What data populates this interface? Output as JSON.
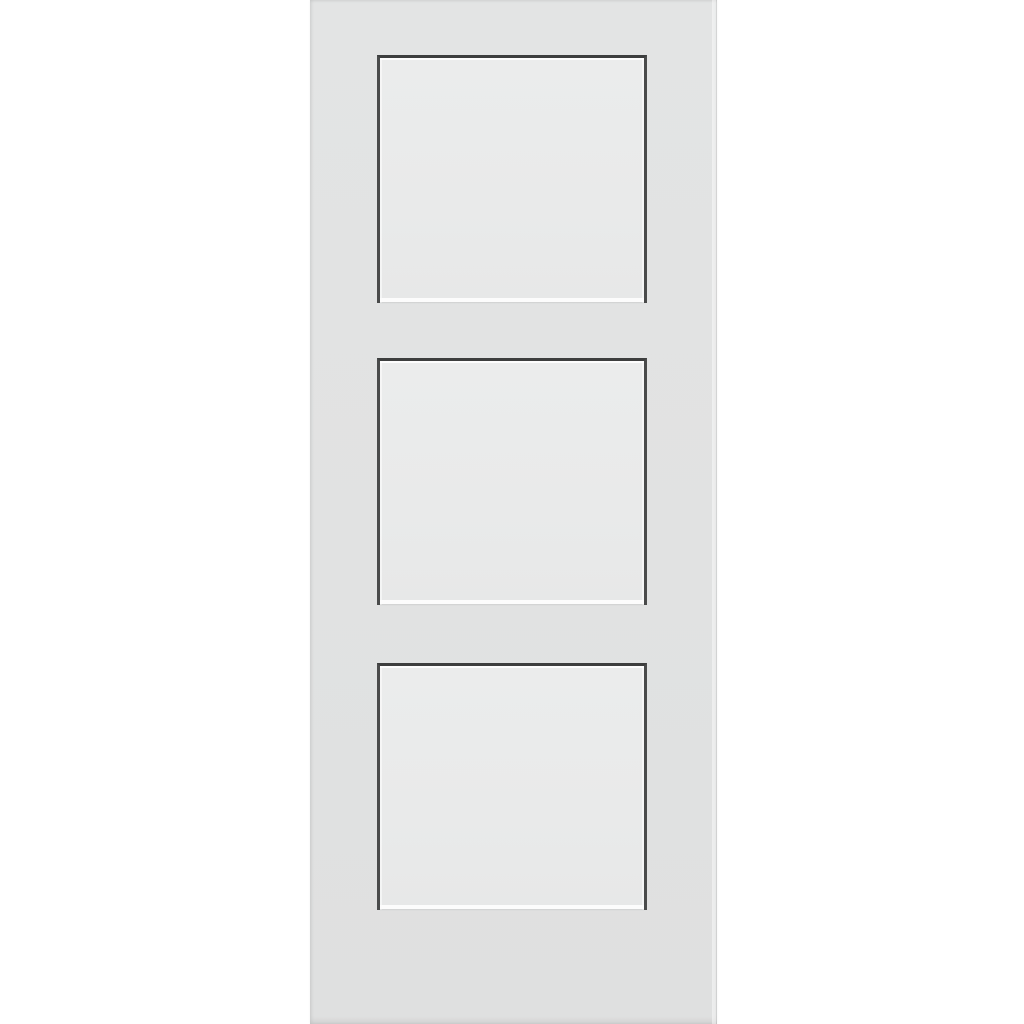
{
  "scene": {
    "subject": "white-three-panel-shaker-door",
    "panel_count": 3,
    "panels": [
      {
        "name": "top-panel"
      },
      {
        "name": "middle-panel"
      },
      {
        "name": "bottom-panel"
      }
    ]
  },
  "colors": {
    "background": "#ffffff",
    "door_slab": "#e1e2e2",
    "panel_field": "#e9eaea",
    "panel_shadow_line": "#3d3e3e",
    "panel_side_shadow_line": "#4a4b4b",
    "panel_bottom_highlight": "#fcfcfc"
  }
}
